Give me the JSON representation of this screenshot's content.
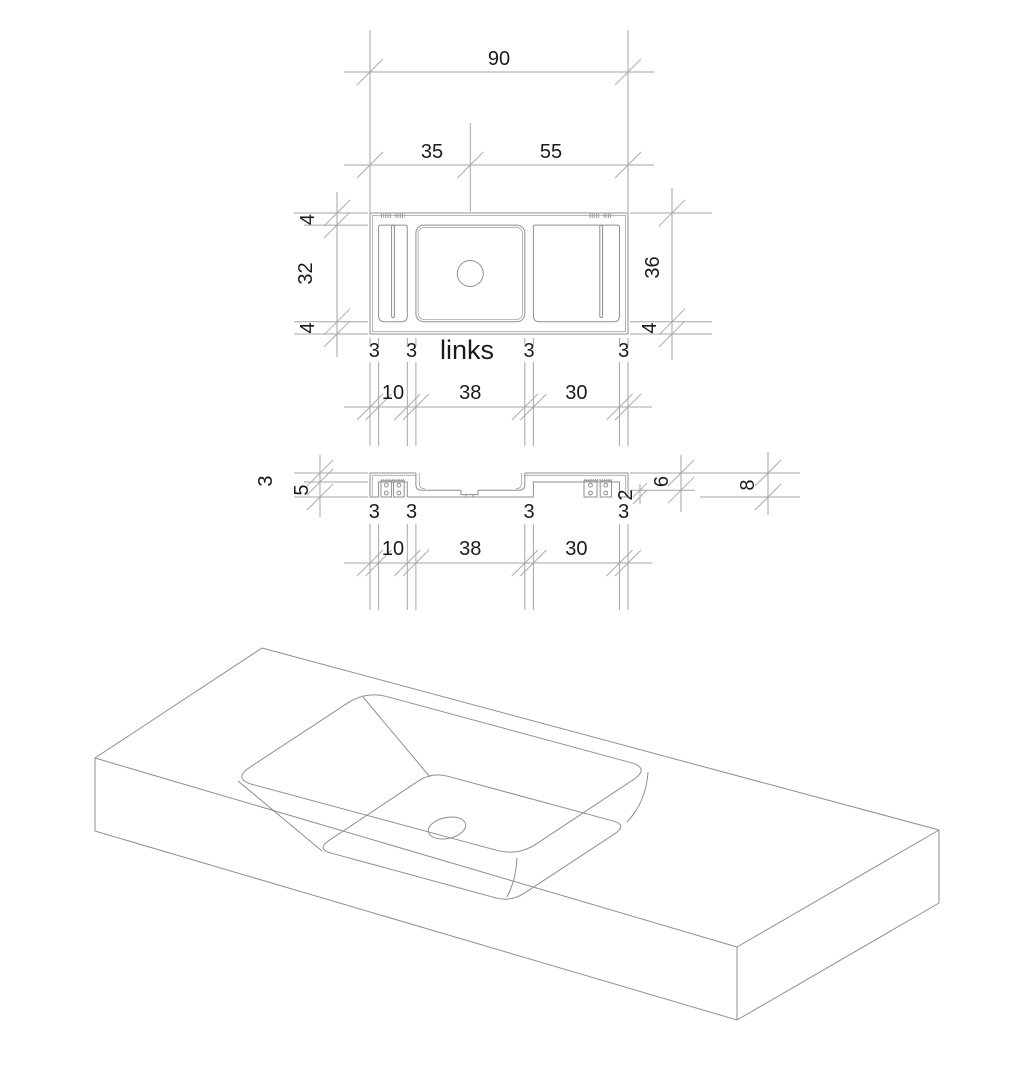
{
  "view_label": "links",
  "plan": {
    "overall_width": "90",
    "tap_offset_left": "35",
    "tap_offset_right": "55",
    "back_rim": "4",
    "inner_depth": "32",
    "front_rim": "4",
    "depth_to_inner_front": "36",
    "front_rim_right": "4",
    "walls": [
      "3",
      "3",
      "3",
      "3"
    ],
    "compartments": [
      "10",
      "38",
      "30"
    ]
  },
  "section": {
    "top_thickness": "3",
    "bottom_recess_depth": "5",
    "basin_depth": "6",
    "floor_thickness": "2",
    "total_thickness": "8",
    "walls": [
      "3",
      "3",
      "3",
      "3"
    ],
    "compartments": [
      "10",
      "38",
      "30"
    ]
  },
  "colors": {
    "object_line": "#8f8f8f",
    "dimension_line": "#a6a6a6",
    "text": "#1b1b1b",
    "background": "#ffffff"
  }
}
